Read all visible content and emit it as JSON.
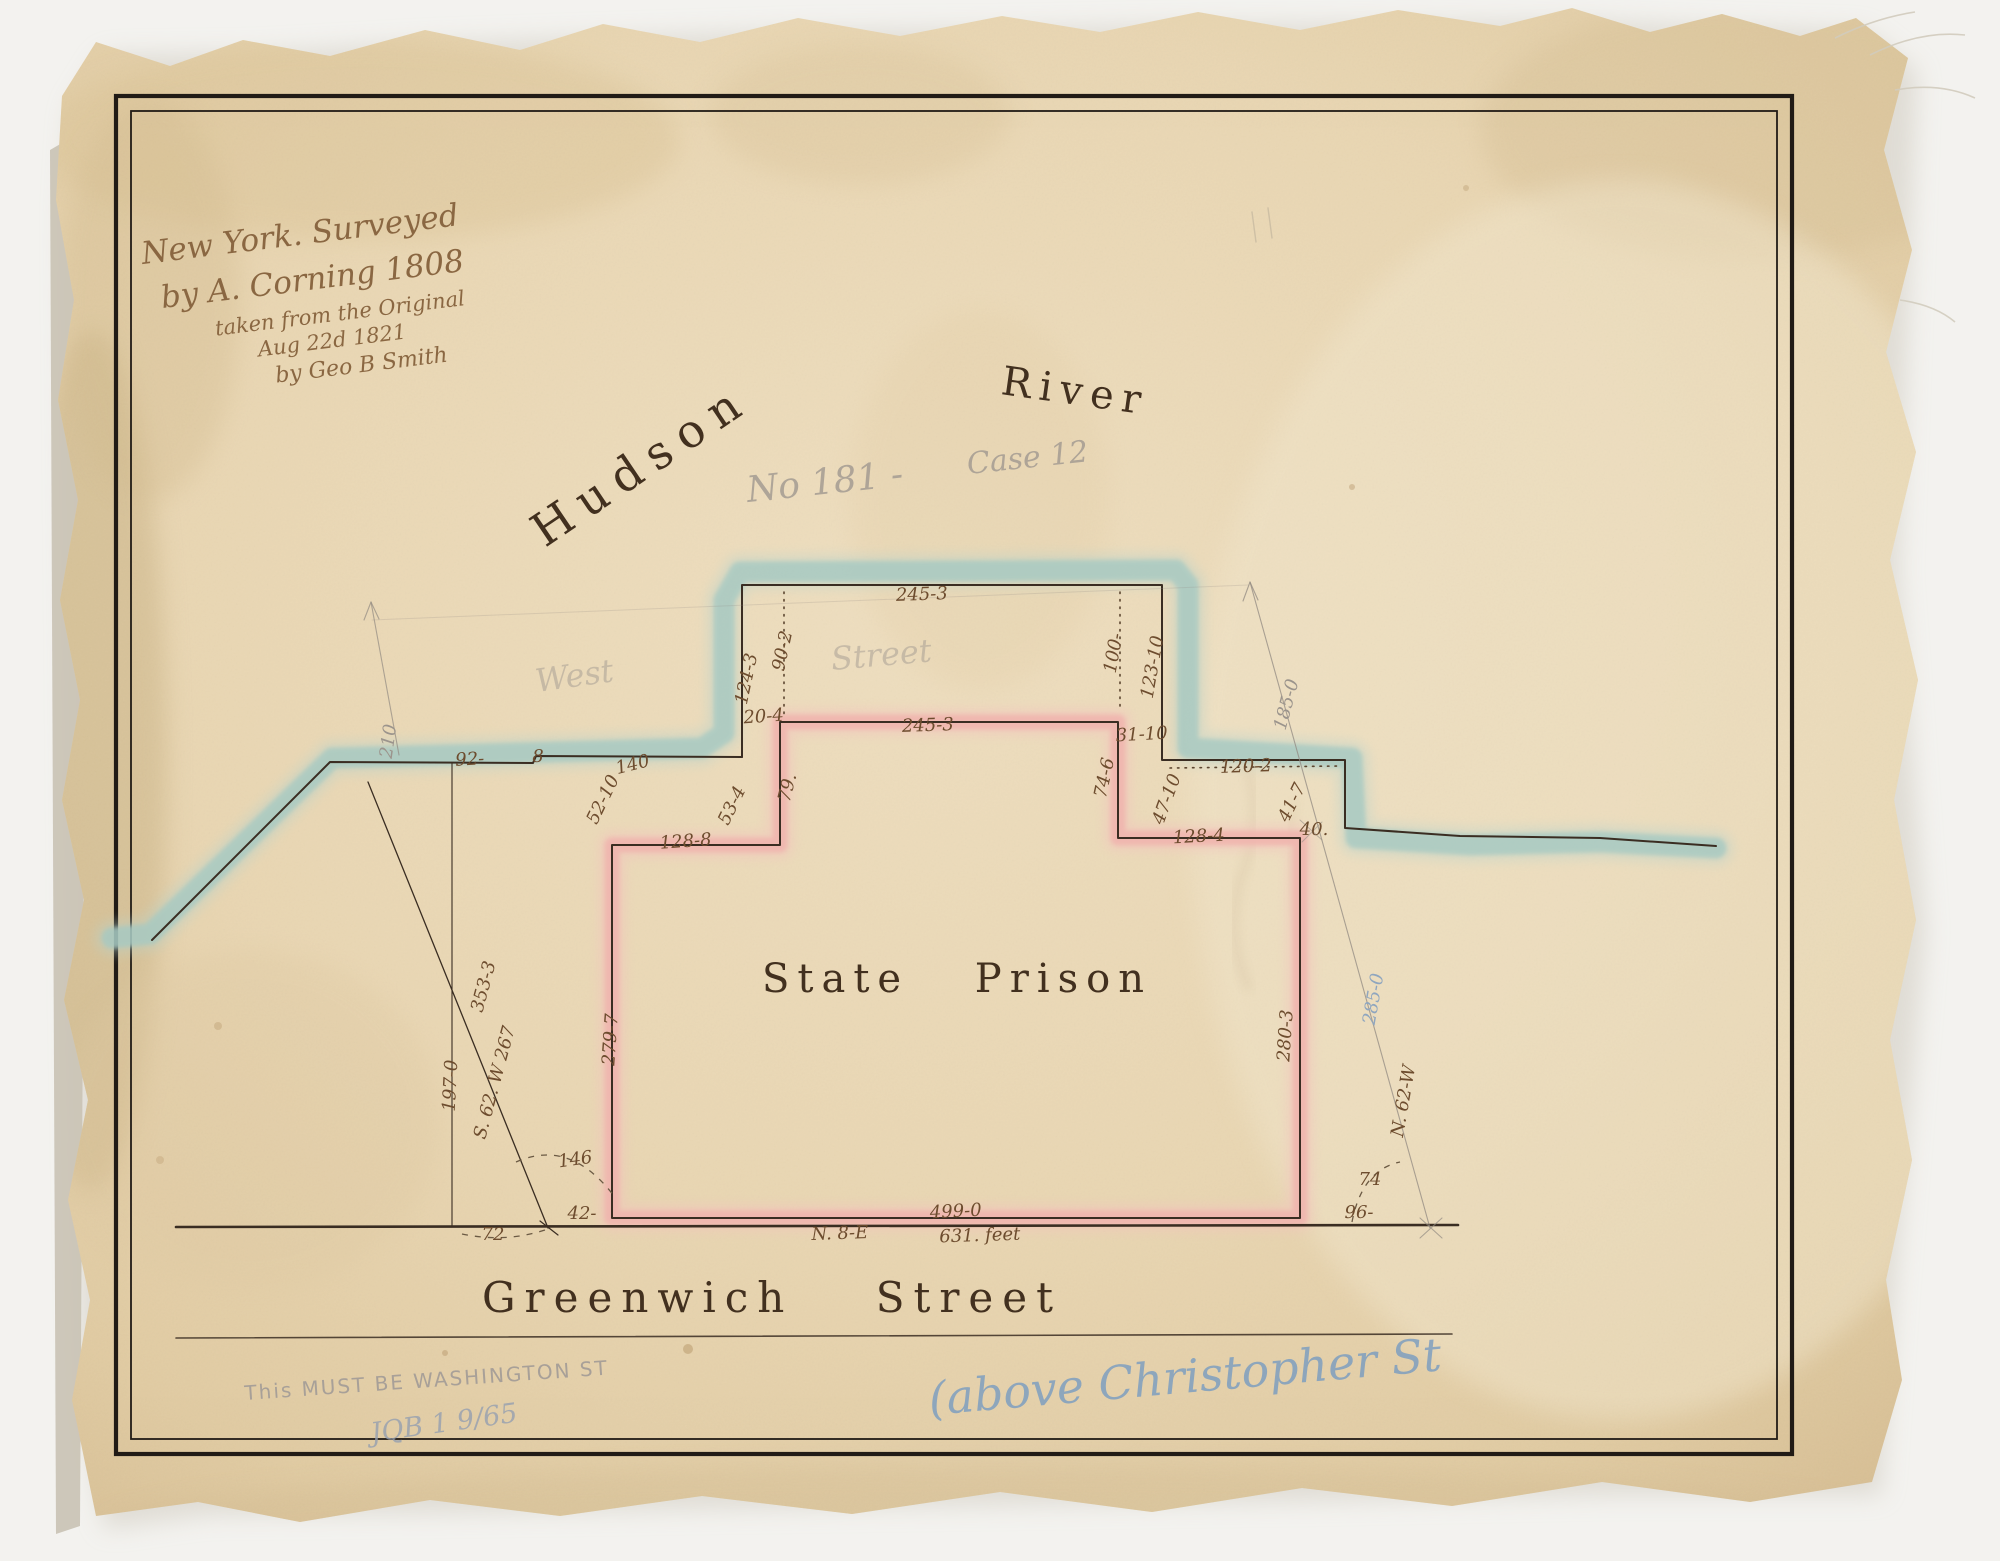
{
  "title_block": {
    "line1": "New York. Surveyed",
    "line2": "by A. Corning 1808",
    "line3": "taken from the Original",
    "line4": "Aug 22d 1821",
    "line5": "by Geo B Smith"
  },
  "water_labels": {
    "hudson": "Hudson",
    "river": "River"
  },
  "plan_labels": {
    "prison": "State Prison",
    "street": "Greenwich Street",
    "west_pencil": "West",
    "street_pencil": "Street"
  },
  "pencil_notes": {
    "number": "No 181 -",
    "case": "Case 12",
    "washington": "This MUST BE WASHINGTON ST",
    "initials": "JQB 1 9/65",
    "blue_crayon": "(above Christopher St"
  },
  "dimensions": {
    "top_width": "245-3",
    "d124_3": "124-3",
    "d90_2": "90-2",
    "d20_4": "20-4",
    "d100": "100-",
    "d123_10": "123-10",
    "d92": "92-",
    "d8": "8",
    "d140": "140",
    "d52_10": "52-10",
    "d53_4": "53-4",
    "d79": "79.",
    "pink_top_width": "245-3",
    "d31_10": "31-10",
    "d74_6": "74-6",
    "d120_2": "120-2",
    "d47_10": "47-10",
    "d41_7": "41-7",
    "d40": "40.",
    "d128_8": "128-8",
    "d128_4": "128-4",
    "west_side": "279-7",
    "east_side": "280-3",
    "d353_3": "353-3",
    "bearing_left": "S. 62. W 267",
    "d197_0": "197-0",
    "angle_146": "146",
    "d42": "42-",
    "d72": "72",
    "bottom_width": "499-0",
    "bearing_bottom": "N. 8-E",
    "total_feet": "631. feet",
    "bearing_right": "N. 62-W",
    "blue_285": "285-0",
    "pencil_185": "185-0",
    "angle_74": "74",
    "d96": "96-",
    "pencil_210": "210"
  },
  "colors": {
    "paper": "#e9d6b2",
    "ink": "#3a2d22",
    "dimension_ink": "#6d4c2e",
    "title_ink": "#8a6742",
    "pink_wash": "#f0b4ae",
    "blue_wash": "#a6c9c2",
    "pencil": "#9b948c",
    "blue_crayon": "#7b9dc0",
    "backdrop": "#f3f2ef"
  }
}
